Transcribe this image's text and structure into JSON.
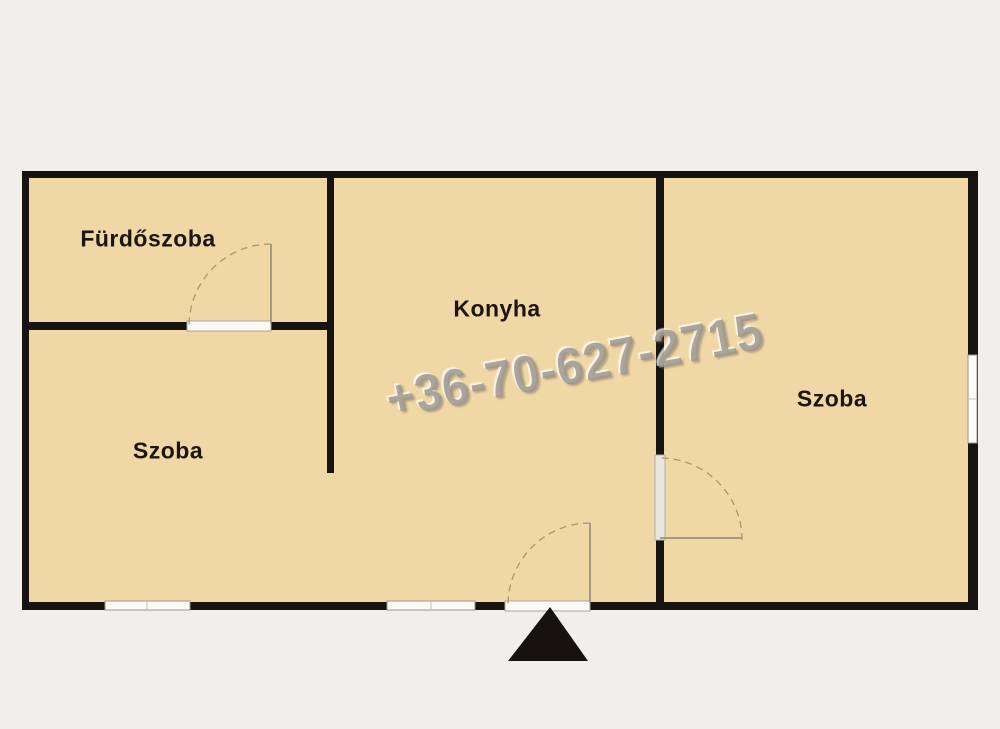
{
  "floorplan": {
    "rooms": [
      {
        "name": "furdoszoba",
        "label": "Fürdőszoba"
      },
      {
        "name": "szoba-left",
        "label": "Szoba"
      },
      {
        "name": "konyha",
        "label": "Konyha"
      },
      {
        "name": "szoba-right",
        "label": "Szoba"
      }
    ],
    "watermark_phone": "+36-70-627-2715",
    "icons": {
      "entrance_marker": "filled-triangle-up"
    },
    "colors": {
      "background": "#f1efec",
      "room_fill": "#f0d7a6",
      "wall": "#171310",
      "opening_fill": "#fbfaf7",
      "opening_border": "#9a978f",
      "door_swing": "#b09468",
      "door_leaf": "#8d8478",
      "watermark": "#9e988e",
      "entrance_marker": "#15120f"
    }
  }
}
